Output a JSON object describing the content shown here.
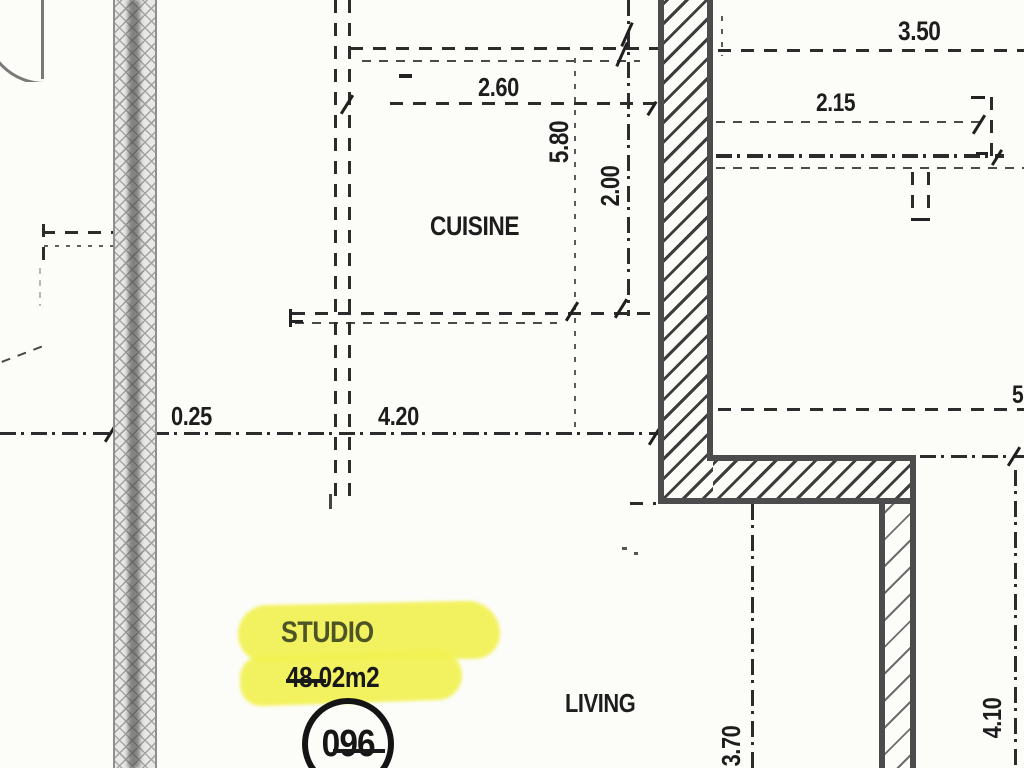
{
  "plan": {
    "rooms": {
      "kitchen": "CUISINE",
      "living": "LIVING"
    },
    "unit": {
      "name": "STUDIO",
      "area": "48.02m2",
      "number": "096"
    },
    "dims": {
      "top_right": "3.50",
      "kitchen_width": "2.60",
      "entry_width": "2.15",
      "kitchen_height": "5.80",
      "kitchen_depth": "2.00",
      "wall_thickness": "0.25",
      "studio_width": "4.20",
      "right_partial": "5",
      "living_height": "3.70",
      "living_right_height": "4.10"
    }
  },
  "colors": {
    "paper": "#fcfcf9",
    "ink": "#1d1d1d",
    "wall_edge": "#4c4c4c",
    "highlight": "#f2f254",
    "studio_text": "#4d5426"
  }
}
